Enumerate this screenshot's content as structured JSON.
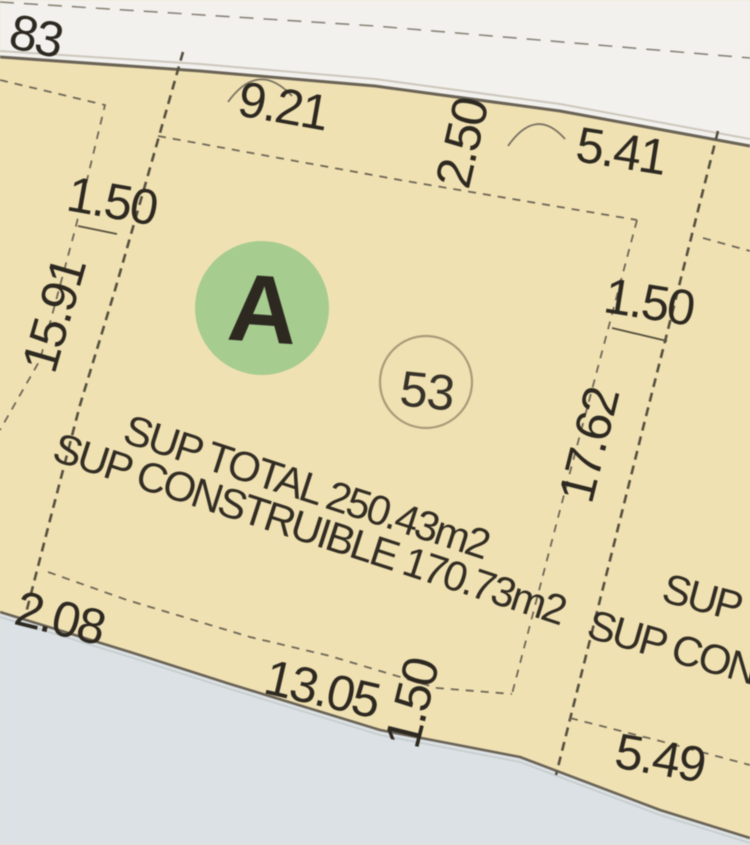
{
  "map": {
    "type": "cadastral-plan",
    "block": {
      "letter": "A"
    },
    "lot": {
      "number": "53",
      "sup_total": "SUP TOTAL 250.43m2",
      "sup_construible": "SUP CONSTRUIBLE 170.73m2"
    },
    "dimensions": {
      "top_left_partial": "83",
      "top_width": "9.21",
      "top_setback": "2.50",
      "top_right_width": "5.41",
      "left_setback": "1.50",
      "left_length": "15.91",
      "right_setback": "1.50",
      "right_length": "17.62",
      "bottom_left": "2.08",
      "bottom_width": "13.05",
      "bottom_setback": "1.50",
      "bottom_right_width": "5.49"
    },
    "neighbor_labels": {
      "sup_total_partial": "SUP T",
      "sup_construible_partial": "SUP CONS"
    },
    "colors": {
      "parcel_fill": "#f0e1b2",
      "road_top_fill": "#f2f1ee",
      "road_bottom_fill": "#dbe1e4",
      "block_circle_fill": "#a7cc8f",
      "block_letter": "#1b2113",
      "boundary_line": "#55503f",
      "setback_line": "#6e6757",
      "dimension_text": "#2d2921",
      "lot_circle_stroke": "#a99b79"
    }
  }
}
